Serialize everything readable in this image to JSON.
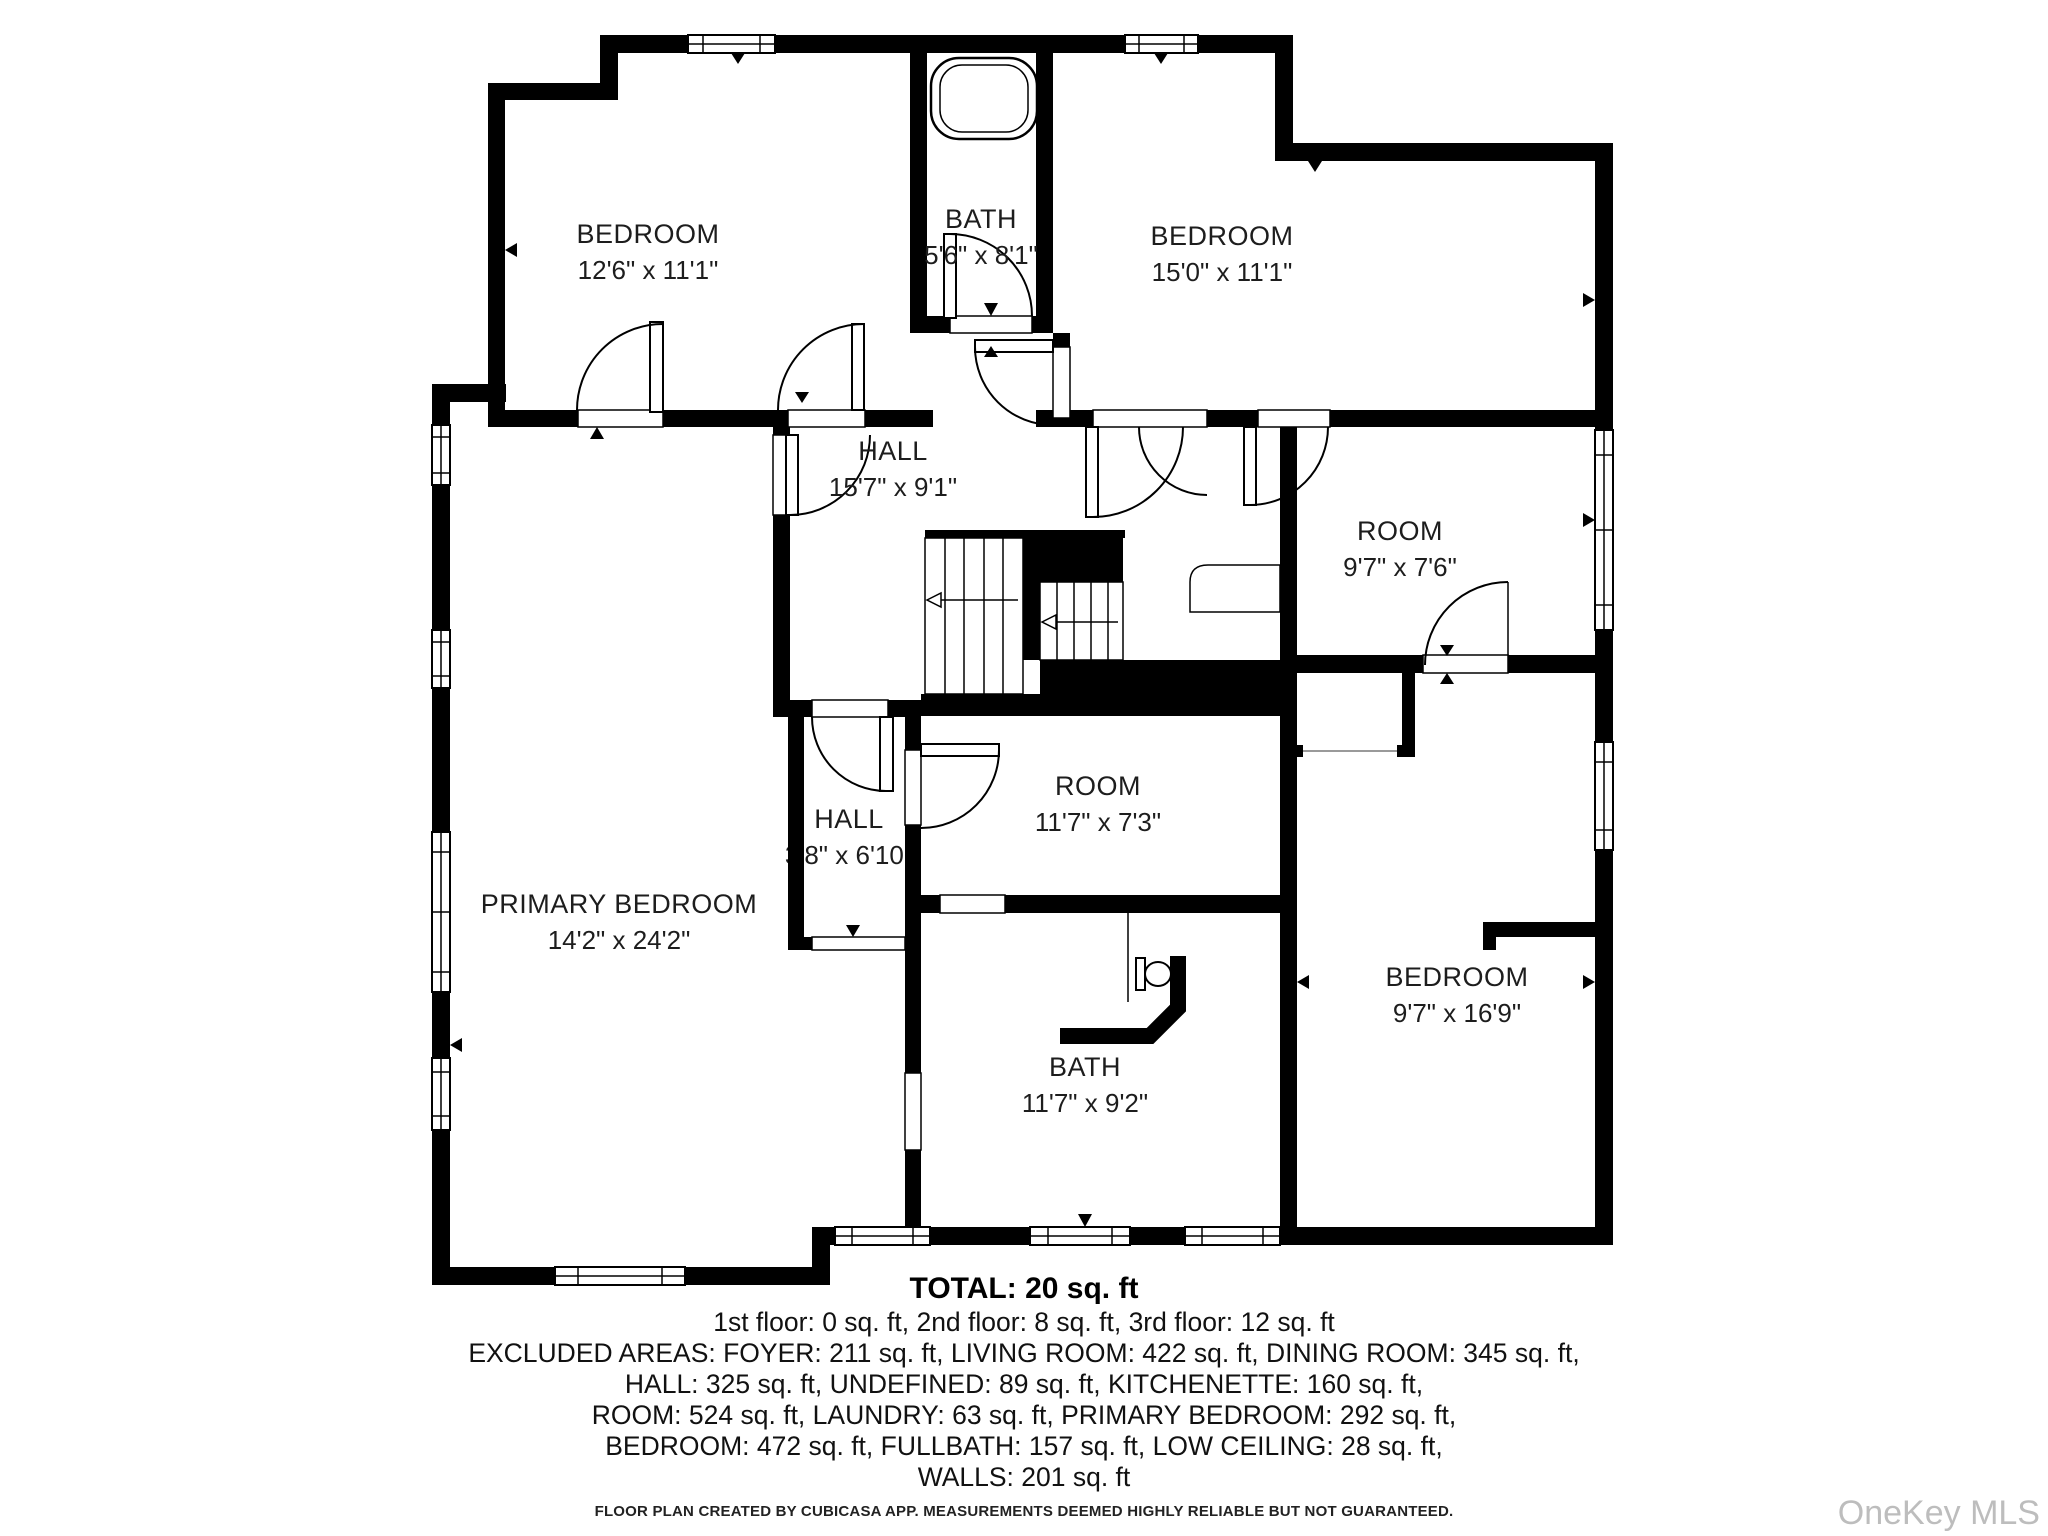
{
  "floor_plan": {
    "rooms": [
      {
        "name": "BEDROOM",
        "dims": "12'6\" x 11'1\"",
        "x": 648,
        "y": 243,
        "under_walls": false
      },
      {
        "name": "BATH",
        "dims": "5'6\" x 8'1\"",
        "x": 981,
        "y": 228,
        "under_walls": false
      },
      {
        "name": "BEDROOM",
        "dims": "15'0\" x 11'1\"",
        "x": 1222,
        "y": 245,
        "under_walls": false
      },
      {
        "name": "HALL",
        "dims": "15'7\" x 9'1\"",
        "x": 893,
        "y": 460,
        "under_walls": false
      },
      {
        "name": "ROOM",
        "dims": "9'7\" x 7'6\"",
        "x": 1400,
        "y": 540,
        "under_walls": false
      },
      {
        "name": "HALL",
        "dims": "3'8\" x 6'10\"",
        "x": 849,
        "y": 828,
        "under_walls": true
      },
      {
        "name": "ROOM",
        "dims": "11'7\" x 7'3\"",
        "x": 1098,
        "y": 795,
        "under_walls": false
      },
      {
        "name": "PRIMARY BEDROOM",
        "dims": "14'2\" x 24'2\"",
        "x": 619,
        "y": 913,
        "under_walls": false
      },
      {
        "name": "BATH",
        "dims": "11'7\" x 9'2\"",
        "x": 1085,
        "y": 1076,
        "under_walls": false
      },
      {
        "name": "BEDROOM",
        "dims": "9'7\" x 16'9\"",
        "x": 1457,
        "y": 986,
        "under_walls": false
      }
    ],
    "summary": {
      "total": "TOTAL: 20 sq. ft",
      "lines": [
        "1st floor: 0 sq. ft, 2nd floor: 8 sq. ft, 3rd floor: 12 sq. ft",
        "EXCLUDED AREAS: FOYER: 211 sq. ft, LIVING ROOM: 422 sq. ft, DINING ROOM: 345 sq. ft,",
        "HALL: 325 sq. ft, UNDEFINED: 89 sq. ft, KITCHENETTE: 160 sq. ft,",
        "ROOM: 524 sq. ft, LAUNDRY: 63 sq. ft, PRIMARY BEDROOM: 292 sq. ft,",
        "BEDROOM: 472 sq. ft, FULLBATH: 157 sq. ft, LOW CEILING: 28 sq. ft,",
        "WALLS: 201 sq. ft"
      ]
    },
    "disclaimer": "FLOOR PLAN CREATED BY CUBICASA APP. MEASUREMENTS DEEMED HIGHLY RELIABLE BUT NOT GUARANTEED.",
    "watermark": "OneKey MLS",
    "colors": {
      "wall": "#000000",
      "label": "#1d1d1d",
      "watermark": "#bdbdbd"
    }
  }
}
